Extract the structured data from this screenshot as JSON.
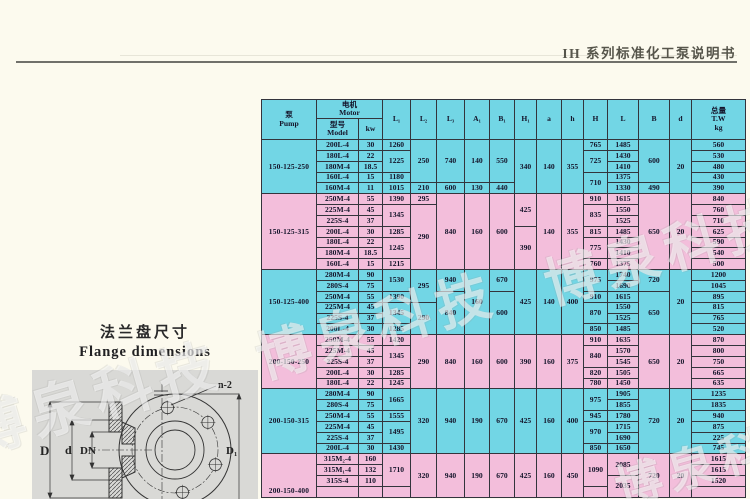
{
  "page": {
    "header_title": "IH 系列标准化工泵说明书"
  },
  "watermark": {
    "text": "博泉科技"
  },
  "colors": {
    "cyan": "#72d6e5",
    "pink": "#f3bedb",
    "border": "#33343c",
    "page_bg": "#fcfaee"
  },
  "flange": {
    "title_zh": "法兰盘尺寸",
    "title_en": "Flange dimensions",
    "labels": {
      "D": "D",
      "d": "d",
      "DN": "DN",
      "D1": "D₁",
      "n2": "n-2"
    }
  },
  "table": {
    "header": {
      "pump": "泵\nPump",
      "motor": "电机\nMotor",
      "model": "型号\nModel",
      "kw": "kw",
      "dims": [
        "L₁",
        "L₂",
        "L₃",
        "A₁",
        "B₁",
        "H₁",
        "a",
        "h",
        "H",
        "L",
        "B",
        "d"
      ],
      "total": "总量\nT.W\nkg"
    },
    "sections": [
      {
        "size": "150-125-250",
        "color": "cyan",
        "rows": [
          [
            {
              "v": "200L-4"
            },
            {
              "v": "30"
            },
            {
              "v": "1260"
            },
            {
              "v": "250",
              "r": 4
            },
            {
              "v": "740",
              "r": 4
            },
            {
              "v": "140",
              "r": 4
            },
            {
              "v": "550",
              "r": 4
            },
            {
              "v": "340",
              "r": 5
            },
            {
              "v": "140",
              "r": 5
            },
            {
              "v": "355",
              "r": 5
            },
            {
              "v": "765"
            },
            {
              "v": "1485"
            },
            {
              "v": "600",
              "r": 4
            },
            {
              "v": "20",
              "r": 5
            },
            {
              "v": "560"
            }
          ],
          [
            {
              "v": "180L-4"
            },
            {
              "v": "22"
            },
            {
              "v": "1225",
              "r": 2
            },
            {
              "v": "725",
              "r": 2
            },
            {
              "v": "1430"
            },
            {
              "v": "530"
            }
          ],
          [
            {
              "v": "180M-4"
            },
            {
              "v": "18.5"
            },
            {
              "v": "1410"
            },
            {
              "v": "480"
            }
          ],
          [
            {
              "v": "160L-4"
            },
            {
              "v": "15"
            },
            {
              "v": "1180"
            },
            {
              "v": "710",
              "r": 2
            },
            {
              "v": "1375"
            },
            {
              "v": "430"
            }
          ],
          [
            {
              "v": "160M-4"
            },
            {
              "v": "11"
            },
            {
              "v": "1015"
            },
            {
              "v": "210"
            },
            {
              "v": "600"
            },
            {
              "v": "130"
            },
            {
              "v": "440"
            },
            {
              "v": "1330"
            },
            {
              "v": "490"
            },
            {
              "v": "390"
            }
          ]
        ]
      },
      {
        "size": "150-125-315",
        "color": "pink",
        "rows": [
          [
            {
              "v": "250M-4"
            },
            {
              "v": "55"
            },
            {
              "v": "1390"
            },
            {
              "v": "295"
            },
            {
              "v": "840",
              "r": 7
            },
            {
              "v": "160",
              "r": 7
            },
            {
              "v": "600",
              "r": 7
            },
            {
              "v": "425",
              "r": 3
            },
            {
              "v": "140",
              "r": 7
            },
            {
              "v": "355",
              "r": 7
            },
            {
              "v": "910"
            },
            {
              "v": "1615"
            },
            {
              "v": "650",
              "r": 7
            },
            {
              "v": "20",
              "r": 7
            },
            {
              "v": "840"
            }
          ],
          [
            {
              "v": "225M-4"
            },
            {
              "v": "45"
            },
            {
              "v": "1345",
              "r": 2
            },
            {
              "v": "290",
              "r": 6
            },
            {
              "v": "835",
              "r": 2
            },
            {
              "v": "1550"
            },
            {
              "v": "760"
            }
          ],
          [
            {
              "v": "225S-4"
            },
            {
              "v": "37"
            },
            {
              "v": "1525"
            },
            {
              "v": "710"
            }
          ],
          [
            {
              "v": "200L-4"
            },
            {
              "v": "30"
            },
            {
              "v": "1285"
            },
            {
              "v": "390",
              "r": 4
            },
            {
              "v": "815"
            },
            {
              "v": "1485"
            },
            {
              "v": "625"
            }
          ],
          [
            {
              "v": "180L-4"
            },
            {
              "v": "22"
            },
            {
              "v": "1245",
              "r": 2
            },
            {
              "v": "775",
              "r": 2
            },
            {
              "v": "1430"
            },
            {
              "v": "590"
            }
          ],
          [
            {
              "v": "180M-4"
            },
            {
              "v": "18.5"
            },
            {
              "v": "1410"
            },
            {
              "v": "540"
            }
          ],
          [
            {
              "v": "160L-4"
            },
            {
              "v": "15"
            },
            {
              "v": "1215"
            },
            {
              "v": "760"
            },
            {
              "v": "1375"
            },
            {
              "v": "500"
            }
          ]
        ]
      },
      {
        "size": "150-125-400",
        "color": "cyan",
        "rows": [
          [
            {
              "v": "280M-4"
            },
            {
              "v": "90"
            },
            {
              "v": "1530",
              "r": 2
            },
            {
              "v": "295",
              "r": 3
            },
            {
              "v": "940",
              "r": 2
            },
            {
              "v": "160",
              "r": 6
            },
            {
              "v": "670",
              "r": 2
            },
            {
              "v": "425",
              "r": 6
            },
            {
              "v": "140",
              "r": 6
            },
            {
              "v": "400",
              "r": 6
            },
            {
              "v": "975",
              "r": 2
            },
            {
              "v": "1740"
            },
            {
              "v": "720",
              "r": 2
            },
            {
              "v": "20",
              "r": 6
            },
            {
              "v": "1200"
            }
          ],
          [
            {
              "v": "280S-4"
            },
            {
              "v": "75"
            },
            {
              "v": "1690"
            },
            {
              "v": "1045"
            }
          ],
          [
            {
              "v": "250M-4"
            },
            {
              "v": "55"
            },
            {
              "v": "1390"
            },
            {
              "v": "840",
              "r": 4
            },
            {
              "v": "600",
              "r": 4
            },
            {
              "v": "910"
            },
            {
              "v": "1615"
            },
            {
              "v": "650",
              "r": 4
            },
            {
              "v": "895"
            }
          ],
          [
            {
              "v": "225M-4"
            },
            {
              "v": "45"
            },
            {
              "v": "1345",
              "r": 2
            },
            {
              "v": "290",
              "r": 3
            },
            {
              "v": "870",
              "r": 2
            },
            {
              "v": "1550"
            },
            {
              "v": "815"
            }
          ],
          [
            {
              "v": "225S-4"
            },
            {
              "v": "37"
            },
            {
              "v": "1525"
            },
            {
              "v": "765"
            }
          ],
          [
            {
              "v": "200L-4"
            },
            {
              "v": "30"
            },
            {
              "v": "1285"
            },
            {
              "v": "850"
            },
            {
              "v": "1485"
            },
            {
              "v": "520"
            }
          ]
        ]
      },
      {
        "size": "200-150-250",
        "color": "pink",
        "rows": [
          [
            {
              "v": "250M-4"
            },
            {
              "v": "55"
            },
            {
              "v": "1420"
            },
            {
              "v": "290",
              "r": 5
            },
            {
              "v": "840",
              "r": 5
            },
            {
              "v": "160",
              "r": 5
            },
            {
              "v": "600",
              "r": 5
            },
            {
              "v": "390",
              "r": 5
            },
            {
              "v": "160",
              "r": 5
            },
            {
              "v": "375",
              "r": 5
            },
            {
              "v": "910"
            },
            {
              "v": "1635"
            },
            {
              "v": "650",
              "r": 5
            },
            {
              "v": "20",
              "r": 5
            },
            {
              "v": "870"
            }
          ],
          [
            {
              "v": "225M-4"
            },
            {
              "v": "45"
            },
            {
              "v": "1345",
              "r": 2
            },
            {
              "v": "840",
              "r": 2
            },
            {
              "v": "1570"
            },
            {
              "v": "800"
            }
          ],
          [
            {
              "v": "225S-4"
            },
            {
              "v": "37"
            },
            {
              "v": "1545"
            },
            {
              "v": "750"
            }
          ],
          [
            {
              "v": "200L-4"
            },
            {
              "v": "30"
            },
            {
              "v": "1285"
            },
            {
              "v": "820"
            },
            {
              "v": "1505"
            },
            {
              "v": "665"
            }
          ],
          [
            {
              "v": "180L-4"
            },
            {
              "v": "22"
            },
            {
              "v": "1245"
            },
            {
              "v": "780"
            },
            {
              "v": "1450"
            },
            {
              "v": "635"
            }
          ]
        ]
      },
      {
        "size": "200-150-315",
        "color": "cyan",
        "rows": [
          [
            {
              "v": "280M-4"
            },
            {
              "v": "90"
            },
            {
              "v": "1665",
              "r": 2
            },
            {
              "v": "320",
              "r": 6
            },
            {
              "v": "940",
              "r": 6
            },
            {
              "v": "190",
              "r": 6
            },
            {
              "v": "670",
              "r": 6
            },
            {
              "v": "425",
              "r": 6
            },
            {
              "v": "160",
              "r": 6
            },
            {
              "v": "400",
              "r": 6
            },
            {
              "v": "975",
              "r": 2
            },
            {
              "v": "1905"
            },
            {
              "v": "720",
              "r": 6
            },
            {
              "v": "20",
              "r": 6
            },
            {
              "v": "1235"
            }
          ],
          [
            {
              "v": "280S-4"
            },
            {
              "v": "75"
            },
            {
              "v": "1855"
            },
            {
              "v": "1835"
            }
          ],
          [
            {
              "v": "250M-4"
            },
            {
              "v": "55"
            },
            {
              "v": "1555"
            },
            {
              "v": "945"
            },
            {
              "v": "1780"
            },
            {
              "v": "940"
            }
          ],
          [
            {
              "v": "225M-4"
            },
            {
              "v": "45"
            },
            {
              "v": "1495",
              "r": 2
            },
            {
              "v": "970",
              "r": 2
            },
            {
              "v": "1715"
            },
            {
              "v": "875"
            }
          ],
          [
            {
              "v": "225S-4"
            },
            {
              "v": "37"
            },
            {
              "v": "1690"
            },
            {
              "v": "225"
            }
          ],
          [
            {
              "v": "200L-4"
            },
            {
              "v": "30"
            },
            {
              "v": "1430"
            },
            {
              "v": "850"
            },
            {
              "v": "1650"
            },
            {
              "v": "745"
            }
          ]
        ]
      },
      {
        "size": "200-150-400",
        "color": "pink",
        "size_valign": "bottom",
        "rows": [
          [
            {
              "v": "315M₂-4"
            },
            {
              "v": "160"
            },
            {
              "v": "1710",
              "r": 3
            },
            {
              "v": "320",
              "r": 4
            },
            {
              "v": "940",
              "r": 4
            },
            {
              "v": "190",
              "r": 4
            },
            {
              "v": "670",
              "r": 4
            },
            {
              "v": "425",
              "r": 4
            },
            {
              "v": "160",
              "r": 4
            },
            {
              "v": "450",
              "r": 4
            },
            {
              "v": "1090",
              "r": 3
            },
            {
              "v": "2085",
              "r": 2
            },
            {
              "v": "720",
              "r": 4
            },
            {
              "v": "20",
              "r": 4
            },
            {
              "v": "1615"
            }
          ],
          [
            {
              "v": "315M₁-4"
            },
            {
              "v": "132"
            },
            {
              "v": "1615"
            }
          ],
          [
            {
              "v": "315S-4"
            },
            {
              "v": "110"
            },
            {
              "v": "2035",
              "r": 2
            },
            {
              "v": "1520"
            }
          ],
          [
            {
              "v": ""
            },
            {
              "v": ""
            },
            {
              "v": ""
            },
            {
              "v": ""
            },
            {
              "v": ""
            }
          ]
        ]
      }
    ]
  }
}
